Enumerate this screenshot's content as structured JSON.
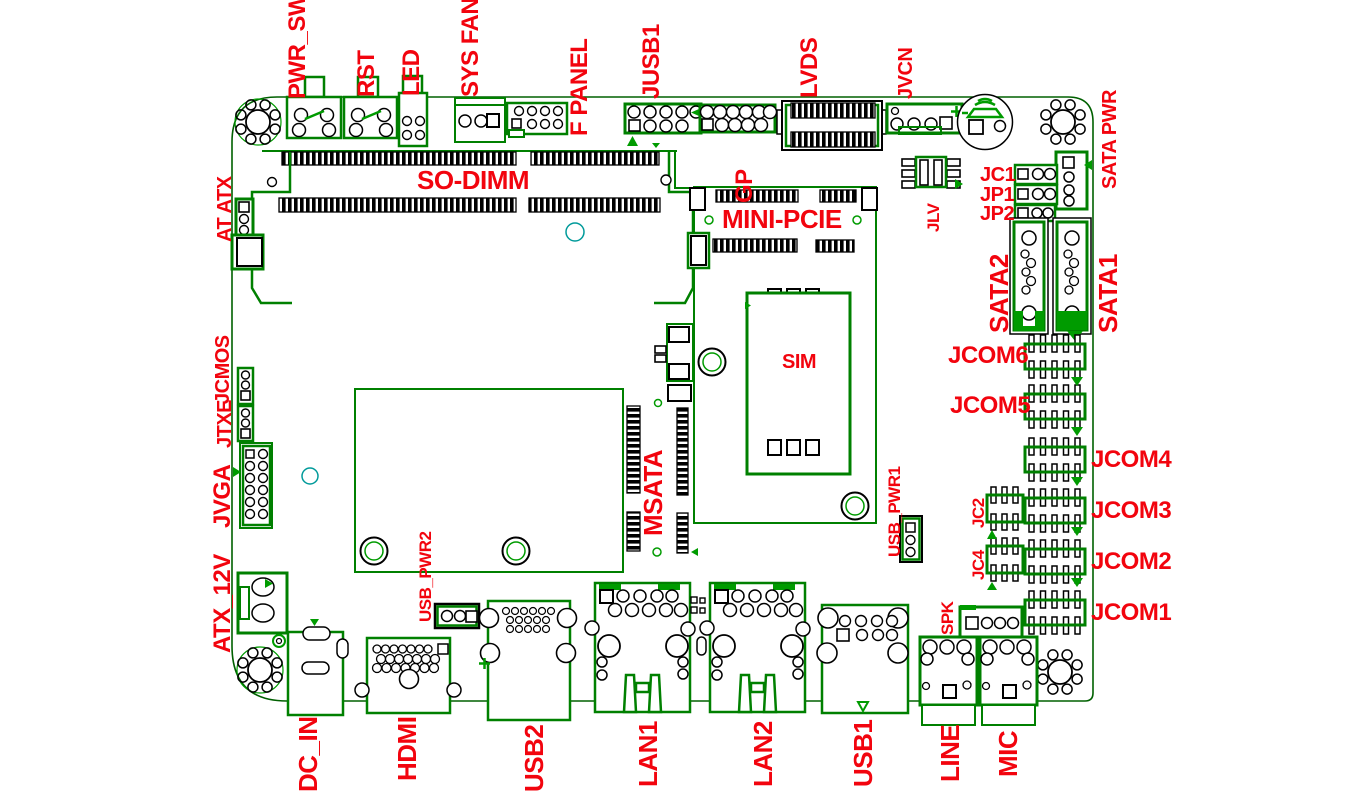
{
  "diagram": {
    "type": "motherboard-connector-location-diagram",
    "colors": {
      "board_outline": "#006000",
      "component_green": "#008000",
      "solid_green": "#009b00",
      "pin_black": "#000000",
      "label_red": "#f2040e",
      "teal_mark": "#009a9a",
      "background": "#ffffff"
    }
  },
  "labels": {
    "pwr_sw": "PWR_SW",
    "rst": "RST",
    "led": "LED",
    "sys_fan": "SYS FAN",
    "f_panel": "F PANEL",
    "jusb1": "JUSB1",
    "gp": "GP",
    "lvds": "LVDS",
    "jvcn": "JVCN",
    "sata_pwr": "SATA PWR",
    "at_atx": "AT ATX",
    "jcmos": "JCMOS",
    "jtxe": "JTXE",
    "jvga": "JVGA",
    "atx_12v": "ATX_12V",
    "so_dimm": "SO-DIMM",
    "mini_pcie": "MINI-PCIE",
    "sim": "SIM",
    "msata": "MSATA",
    "jlv": "JLV",
    "jc1": "JC1",
    "jp1": "JP1",
    "jp2": "JP2",
    "sata2": "SATA2",
    "sata1": "SATA1",
    "jcom6": "JCOM6",
    "jcom5": "JCOM5",
    "jcom4": "JCOM4",
    "jcom3": "JCOM3",
    "jcom2": "JCOM2",
    "jcom1": "JCOM1",
    "jc2": "JC2",
    "jc4": "JC4",
    "usb_pwr1": "USB_PWR1",
    "usb_pwr2": "USB_PWR2",
    "spk": "SPK",
    "dc_in": "DC_IN",
    "hdmi": "HDMI",
    "usb2": "USB2",
    "lan1": "LAN1",
    "lan2": "LAN2",
    "usb1": "USB1",
    "line": "LINE",
    "mic": "MIC"
  }
}
